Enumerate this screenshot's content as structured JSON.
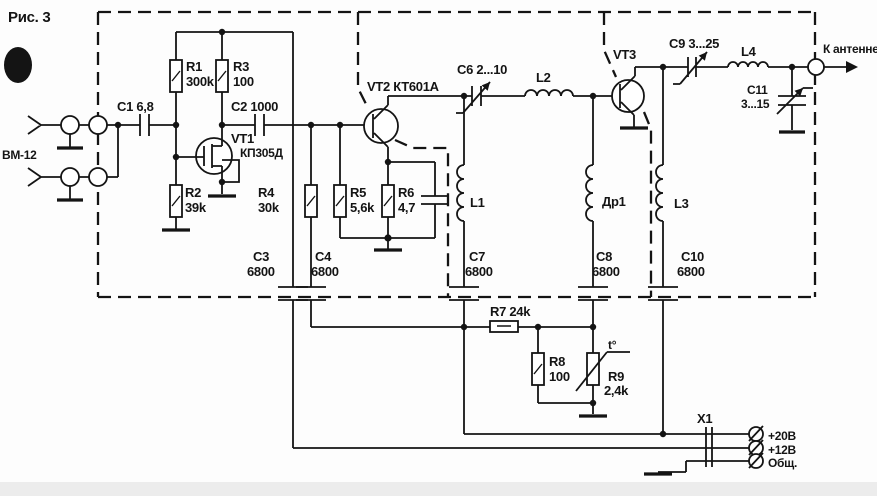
{
  "figure": {
    "caption": "Рис. 3"
  },
  "source": {
    "label": "ВМ-12"
  },
  "antenna": {
    "label": "К антенне"
  },
  "x1": {
    "name": "X1",
    "pins": [
      "+20В",
      "+12В",
      "Общ."
    ]
  },
  "colors": {
    "ink": "#141414",
    "paper": "#fdfdfd"
  },
  "transistors": {
    "vt1": {
      "name": "VT1",
      "type": "КП305Д"
    },
    "vt2": {
      "label": "VT2 КТ601А"
    },
    "vt3": {
      "label": "VT3"
    }
  },
  "resistors": {
    "r1": {
      "name": "R1",
      "value": "300k"
    },
    "r2": {
      "name": "R2",
      "value": "39k"
    },
    "r3": {
      "name": "R3",
      "value": "100"
    },
    "r4": {
      "name": "R4",
      "value": "30k"
    },
    "r5": {
      "name": "R5",
      "value": "5,6k"
    },
    "r6": {
      "name": "R6",
      "value": "4,7"
    },
    "r7": {
      "label": "R7 24k"
    },
    "r8": {
      "name": "R8",
      "value": "100"
    },
    "r9": {
      "name": "R9",
      "value": "2,4k",
      "temp_mark": "t°"
    }
  },
  "capacitors": {
    "c1": {
      "label": "C1 6,8"
    },
    "c2": {
      "label": "C2 1000"
    },
    "c3": {
      "name": "C3",
      "value": "6800"
    },
    "c4": {
      "name": "C4",
      "value": "6800"
    },
    "c6": {
      "label": "C6 2...10"
    },
    "c7": {
      "name": "C7",
      "value": "6800"
    },
    "c8": {
      "name": "C8",
      "value": "6800"
    },
    "c9": {
      "label": "C9 3...25"
    },
    "c10": {
      "name": "C10",
      "value": "6800"
    },
    "c11": {
      "name": "C11",
      "value": "3...15"
    }
  },
  "inductors": {
    "l1": {
      "label": "L1"
    },
    "l2": {
      "label": "L2"
    },
    "l3": {
      "label": "L3"
    },
    "l4": {
      "label": "L4"
    },
    "dr1": {
      "label": "Др1"
    }
  }
}
